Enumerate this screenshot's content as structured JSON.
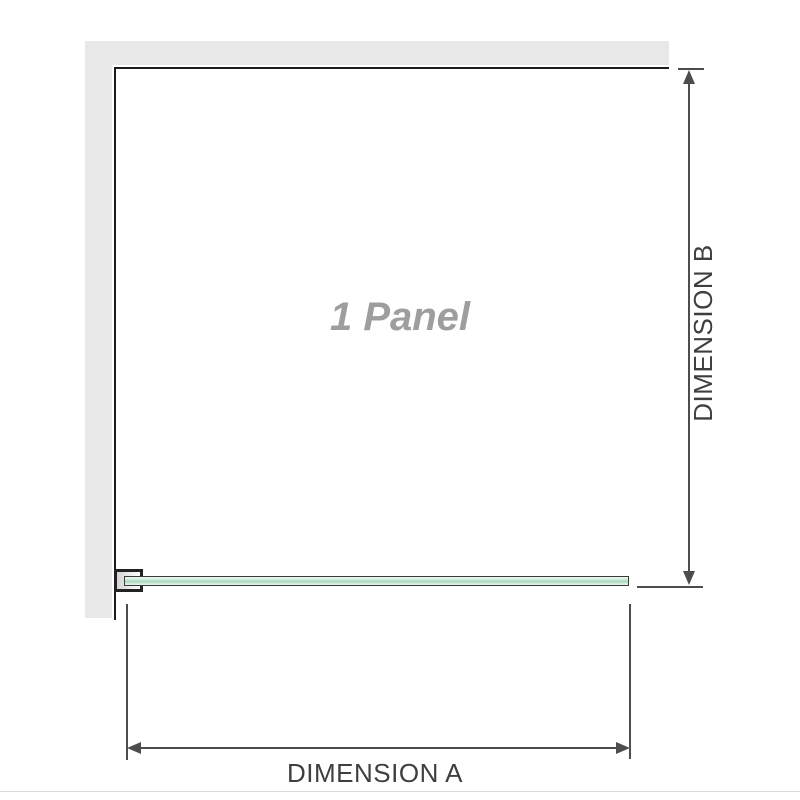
{
  "diagram": {
    "title": "shower-screen-panel-dimension-diagram",
    "panel_label": "1 Panel",
    "dimension_a": {
      "label": "DIMENSION A"
    },
    "dimension_b": {
      "label": "DIMENSION B"
    },
    "icons": {
      "arrows": [
        "arrow-up-icon",
        "arrow-down-icon",
        "arrow-left-icon",
        "arrow-right-icon"
      ]
    },
    "colors": {
      "wall": "#e8e8e8",
      "wall_edge": "#1c1c1c",
      "dimension": "#4d4d4d",
      "label_text": "#3f3f3f",
      "panel_text": "#9e9e9e",
      "glass_border": "#3a3a3a",
      "glass_light": "#d2ecdd",
      "glass_dark": "#a6d7ba",
      "bracket_border": "#222222",
      "separator": "#d9d9d9"
    }
  }
}
